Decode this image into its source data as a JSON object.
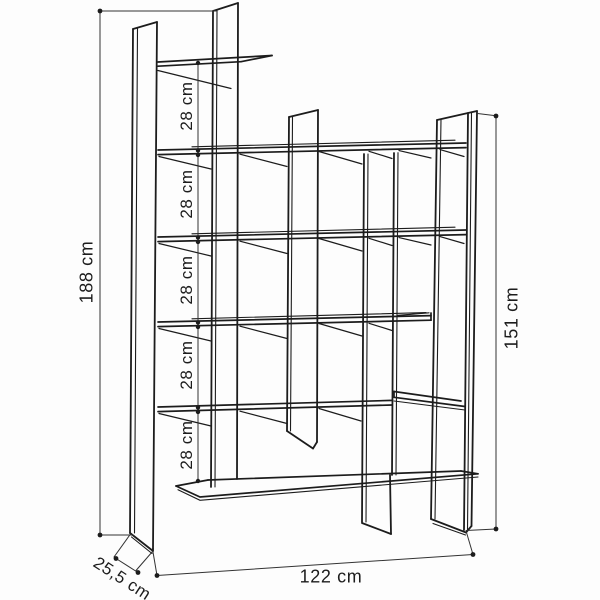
{
  "diagram": {
    "type": "furniture-dimension-line-drawing",
    "subject": "staggered shelving unit / bookcase",
    "background": "#fdfdfd",
    "line_color": "#1c1c1c",
    "dimension_line_color": "#333333",
    "labels": {
      "total_height": "188 cm",
      "shelf_gaps": [
        "28 cm",
        "28 cm",
        "28 cm",
        "28 cm",
        "28 cm"
      ],
      "right_side_height": "151 cm",
      "total_width": "122 cm",
      "depth": "25,5 cm"
    }
  }
}
